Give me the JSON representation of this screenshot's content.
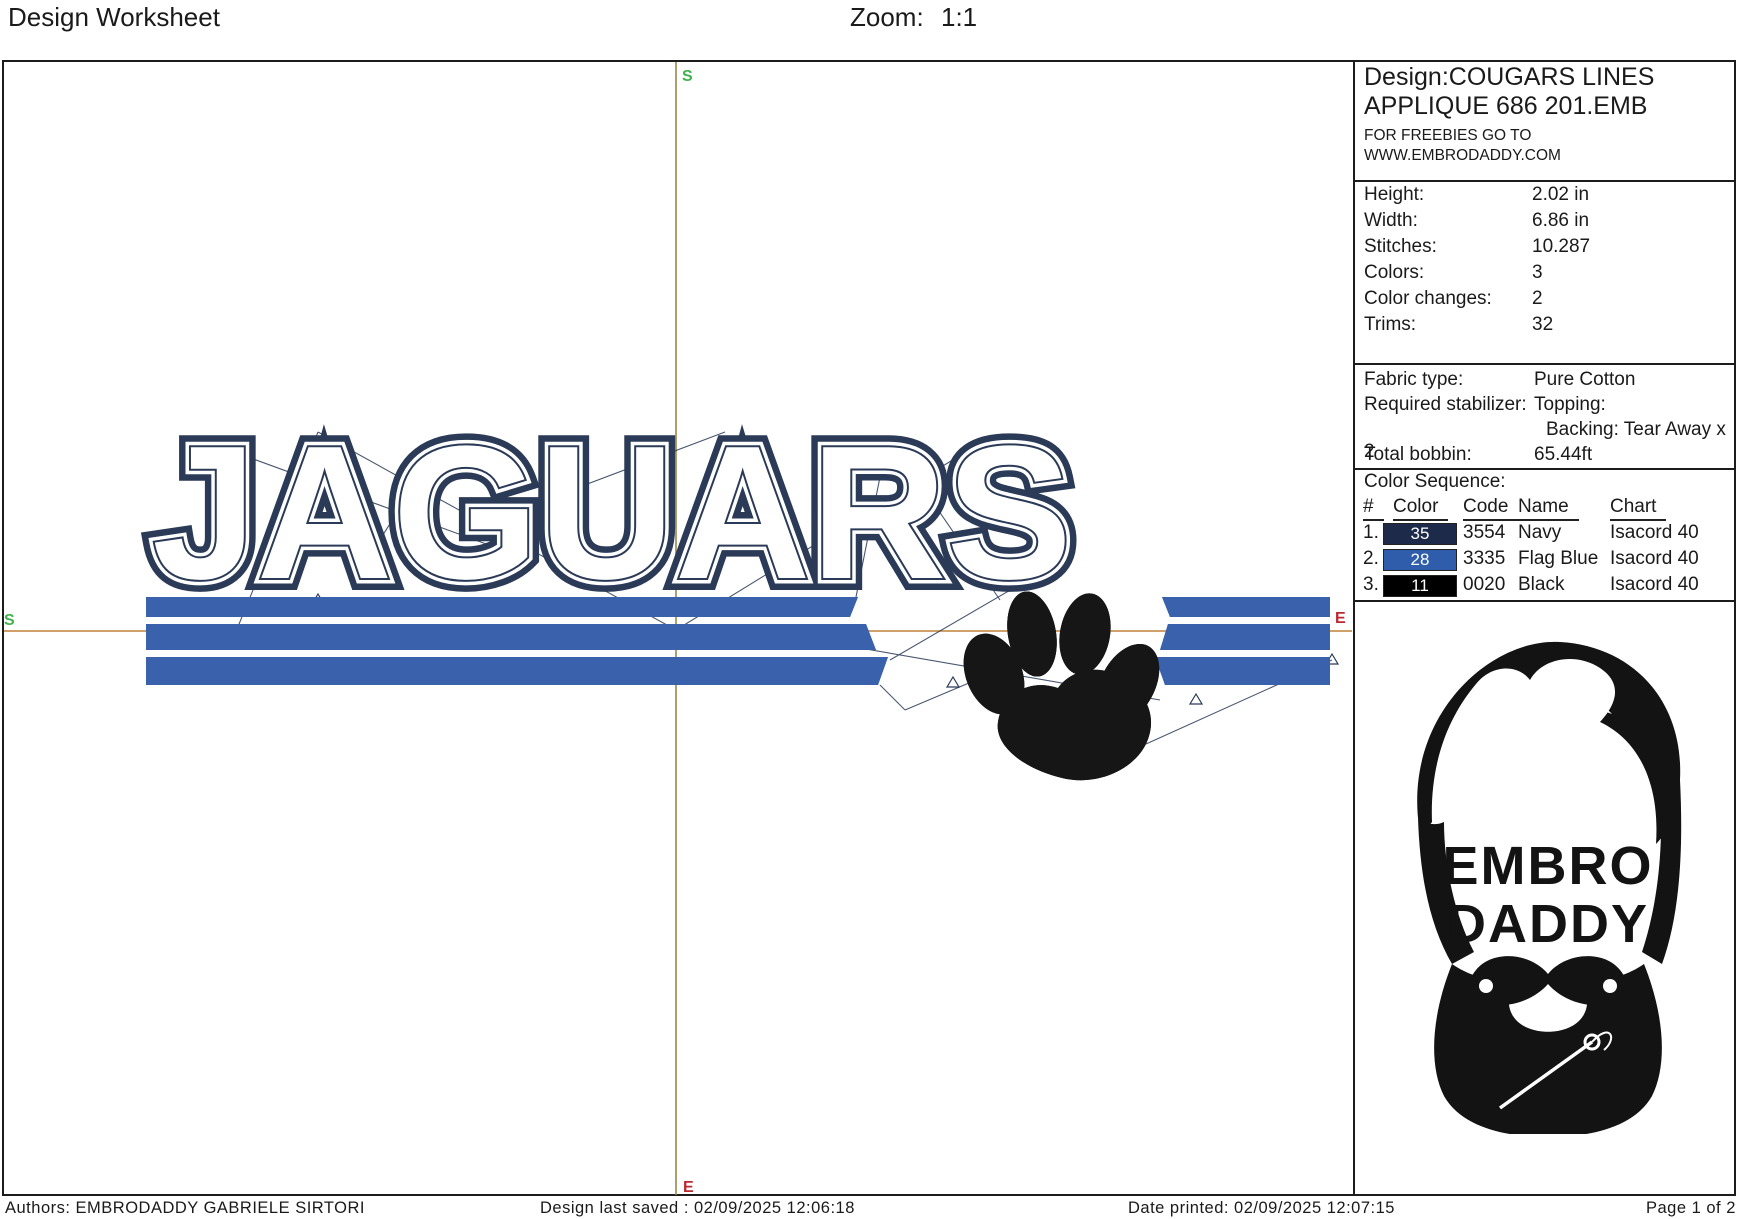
{
  "header": {
    "title": "Design Worksheet",
    "zoom_label": "Zoom:",
    "zoom_value": "1:1"
  },
  "canvas": {
    "design_text": "JAGUARS",
    "markers": {
      "start": "S",
      "end": "E"
    },
    "colors": {
      "letter_navy": "#2a3a57",
      "stripe_blue": "#3a61ac",
      "paw_black": "#161616",
      "crosshair_vertical": "#998749",
      "crosshair_horizontal": "#c08138",
      "marker_start_green": "#3eb24d",
      "marker_end_red": "#bb2a30"
    }
  },
  "panel": {
    "title_line1": "Design:COUGARS LINES",
    "title_line2": "APPLIQUE 686 201.EMB",
    "freebies_line1": "FOR FREEBIES GO TO",
    "freebies_line2": "WWW.EMBRODADDY.COM",
    "stats": {
      "rows": [
        {
          "label": "Height:",
          "value": "2.02 in"
        },
        {
          "label": "Width:",
          "value": "6.86 in"
        },
        {
          "label": "Stitches:",
          "value": "10.287"
        },
        {
          "label": "Colors:",
          "value": "3"
        },
        {
          "label": "Color changes:",
          "value": "2"
        },
        {
          "label": "Trims:",
          "value": "32"
        }
      ]
    },
    "fabric": {
      "rows": [
        {
          "label": "Fabric type:",
          "value": "Pure Cotton"
        },
        {
          "label": "Required stabilizer:",
          "value": "Topping:"
        },
        {
          "label": "",
          "value": "Backing: Tear Away x 2"
        },
        {
          "label": "Total bobbin:",
          "value": "65.44ft"
        }
      ]
    },
    "color_sequence": {
      "title": "Color Sequence:",
      "headers": {
        "num": "#",
        "color": "Color",
        "code": "Code",
        "name": "Name",
        "chart": "Chart"
      },
      "rows": [
        {
          "index": "1.",
          "color_number": "35",
          "swatch": "#1e2a4a",
          "code": "3554",
          "name": "Navy",
          "chart": "Isacord 40"
        },
        {
          "index": "2.",
          "color_number": "28",
          "swatch": "#2f5cab",
          "code": "3335",
          "name": "Flag Blue",
          "chart": "Isacord 40"
        },
        {
          "index": "3.",
          "color_number": "11",
          "swatch": "#000000",
          "code": "0020",
          "name": "Black",
          "chart": "Isacord 40"
        }
      ]
    },
    "logo": {
      "line1": "EMBRO",
      "line2": "DADDY"
    }
  },
  "footer": {
    "authors": "Authors: EMBRODADDY GABRIELE SIRTORI",
    "last_saved": "Design last saved : 02/09/2025 12:06:18",
    "printed": "Date printed: 02/09/2025 12:07:15",
    "page": "Page 1 of 2"
  }
}
